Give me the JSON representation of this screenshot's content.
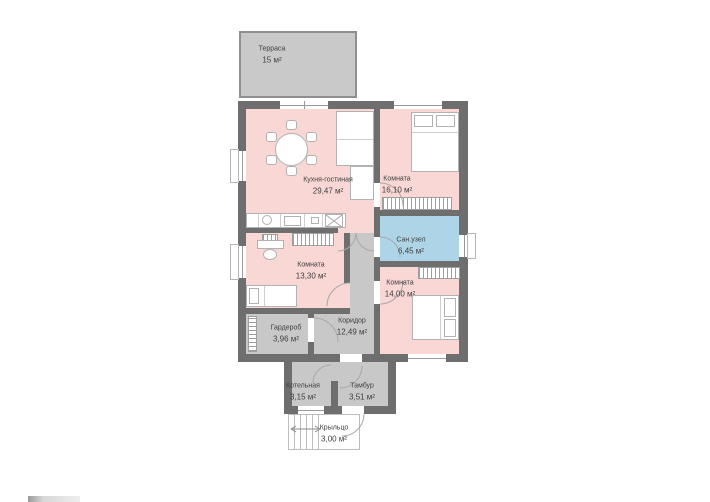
{
  "plan": {
    "title": "Floor plan",
    "rooms": {
      "terrace": {
        "name": "Терраса",
        "area": "15 м²"
      },
      "kitchen_living": {
        "name": "Кухня-гостиная",
        "area": "29,47 м²"
      },
      "bedroom_top": {
        "name": "Комната",
        "area": "16,10 м²"
      },
      "bathroom": {
        "name": "Сан.узел",
        "area": "6,45 м²"
      },
      "bedroom_left": {
        "name": "Комната",
        "area": "13,30 м²"
      },
      "bedroom_bottom": {
        "name": "Комната",
        "area": "14,00 м²"
      },
      "wardrobe_room": {
        "name": "Гардероб",
        "area": "3,96 м²"
      },
      "corridor": {
        "name": "Коридор",
        "area": "12,49 м²"
      },
      "boiler_room": {
        "name": "Котельная",
        "area": "3,15 м²"
      },
      "vestibule": {
        "name": "Тамбур",
        "area": "3,51 м²"
      },
      "porch": {
        "name": "Крыльцо",
        "area": "3,00 м²"
      }
    },
    "colors": {
      "wall": "#6e6e6e",
      "living_room_fill": "#f8d7d4",
      "bathroom_fill": "#aed5e7",
      "utility_fill": "#c8c8c8",
      "terrace_fill": "#c9c9c9",
      "furniture_outline": "#b2b2b2",
      "text": "#3f3f3f"
    }
  }
}
